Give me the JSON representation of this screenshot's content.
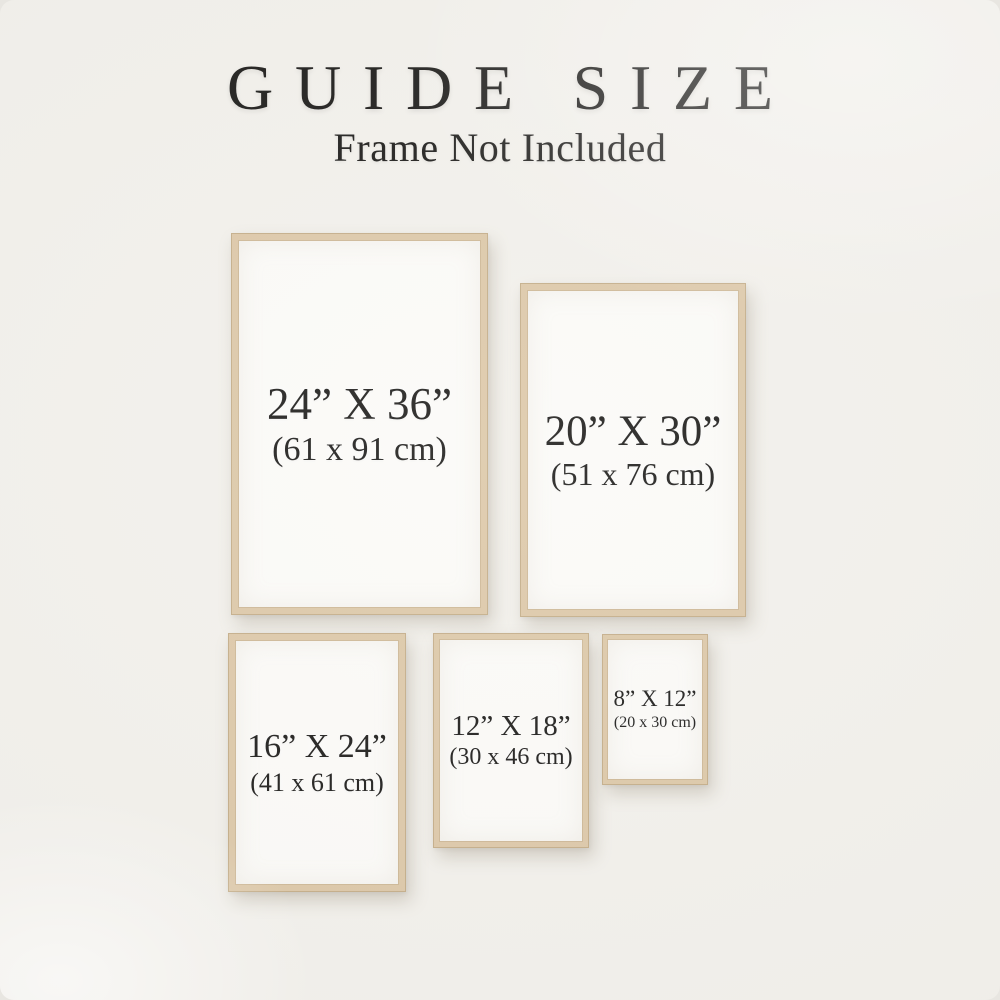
{
  "header": {
    "title": "GUIDE SIZE",
    "subtitle": "Frame Not Included"
  },
  "frames": [
    {
      "id": "24x36",
      "inches": "24” X 36”",
      "centimeters": "(61 x 91 cm)"
    },
    {
      "id": "20x30",
      "inches": "20” X 30”",
      "centimeters": "(51 x 76 cm)"
    },
    {
      "id": "16x24",
      "inches": "16” X 24”",
      "centimeters": "(41 x 61 cm)"
    },
    {
      "id": "12x18",
      "inches": "12” X 18”",
      "centimeters": "(30 x 46 cm)"
    },
    {
      "id": "8x12",
      "inches": "8” X 12”",
      "centimeters": "(20 x 30 cm)"
    }
  ],
  "colors": {
    "background": "#f2f0eb",
    "frame_wood": "#dcc7a7",
    "frame_wood_edge": "#c3ac87",
    "poster_paper": "#fbfaf7",
    "text": "#1c1b19"
  }
}
